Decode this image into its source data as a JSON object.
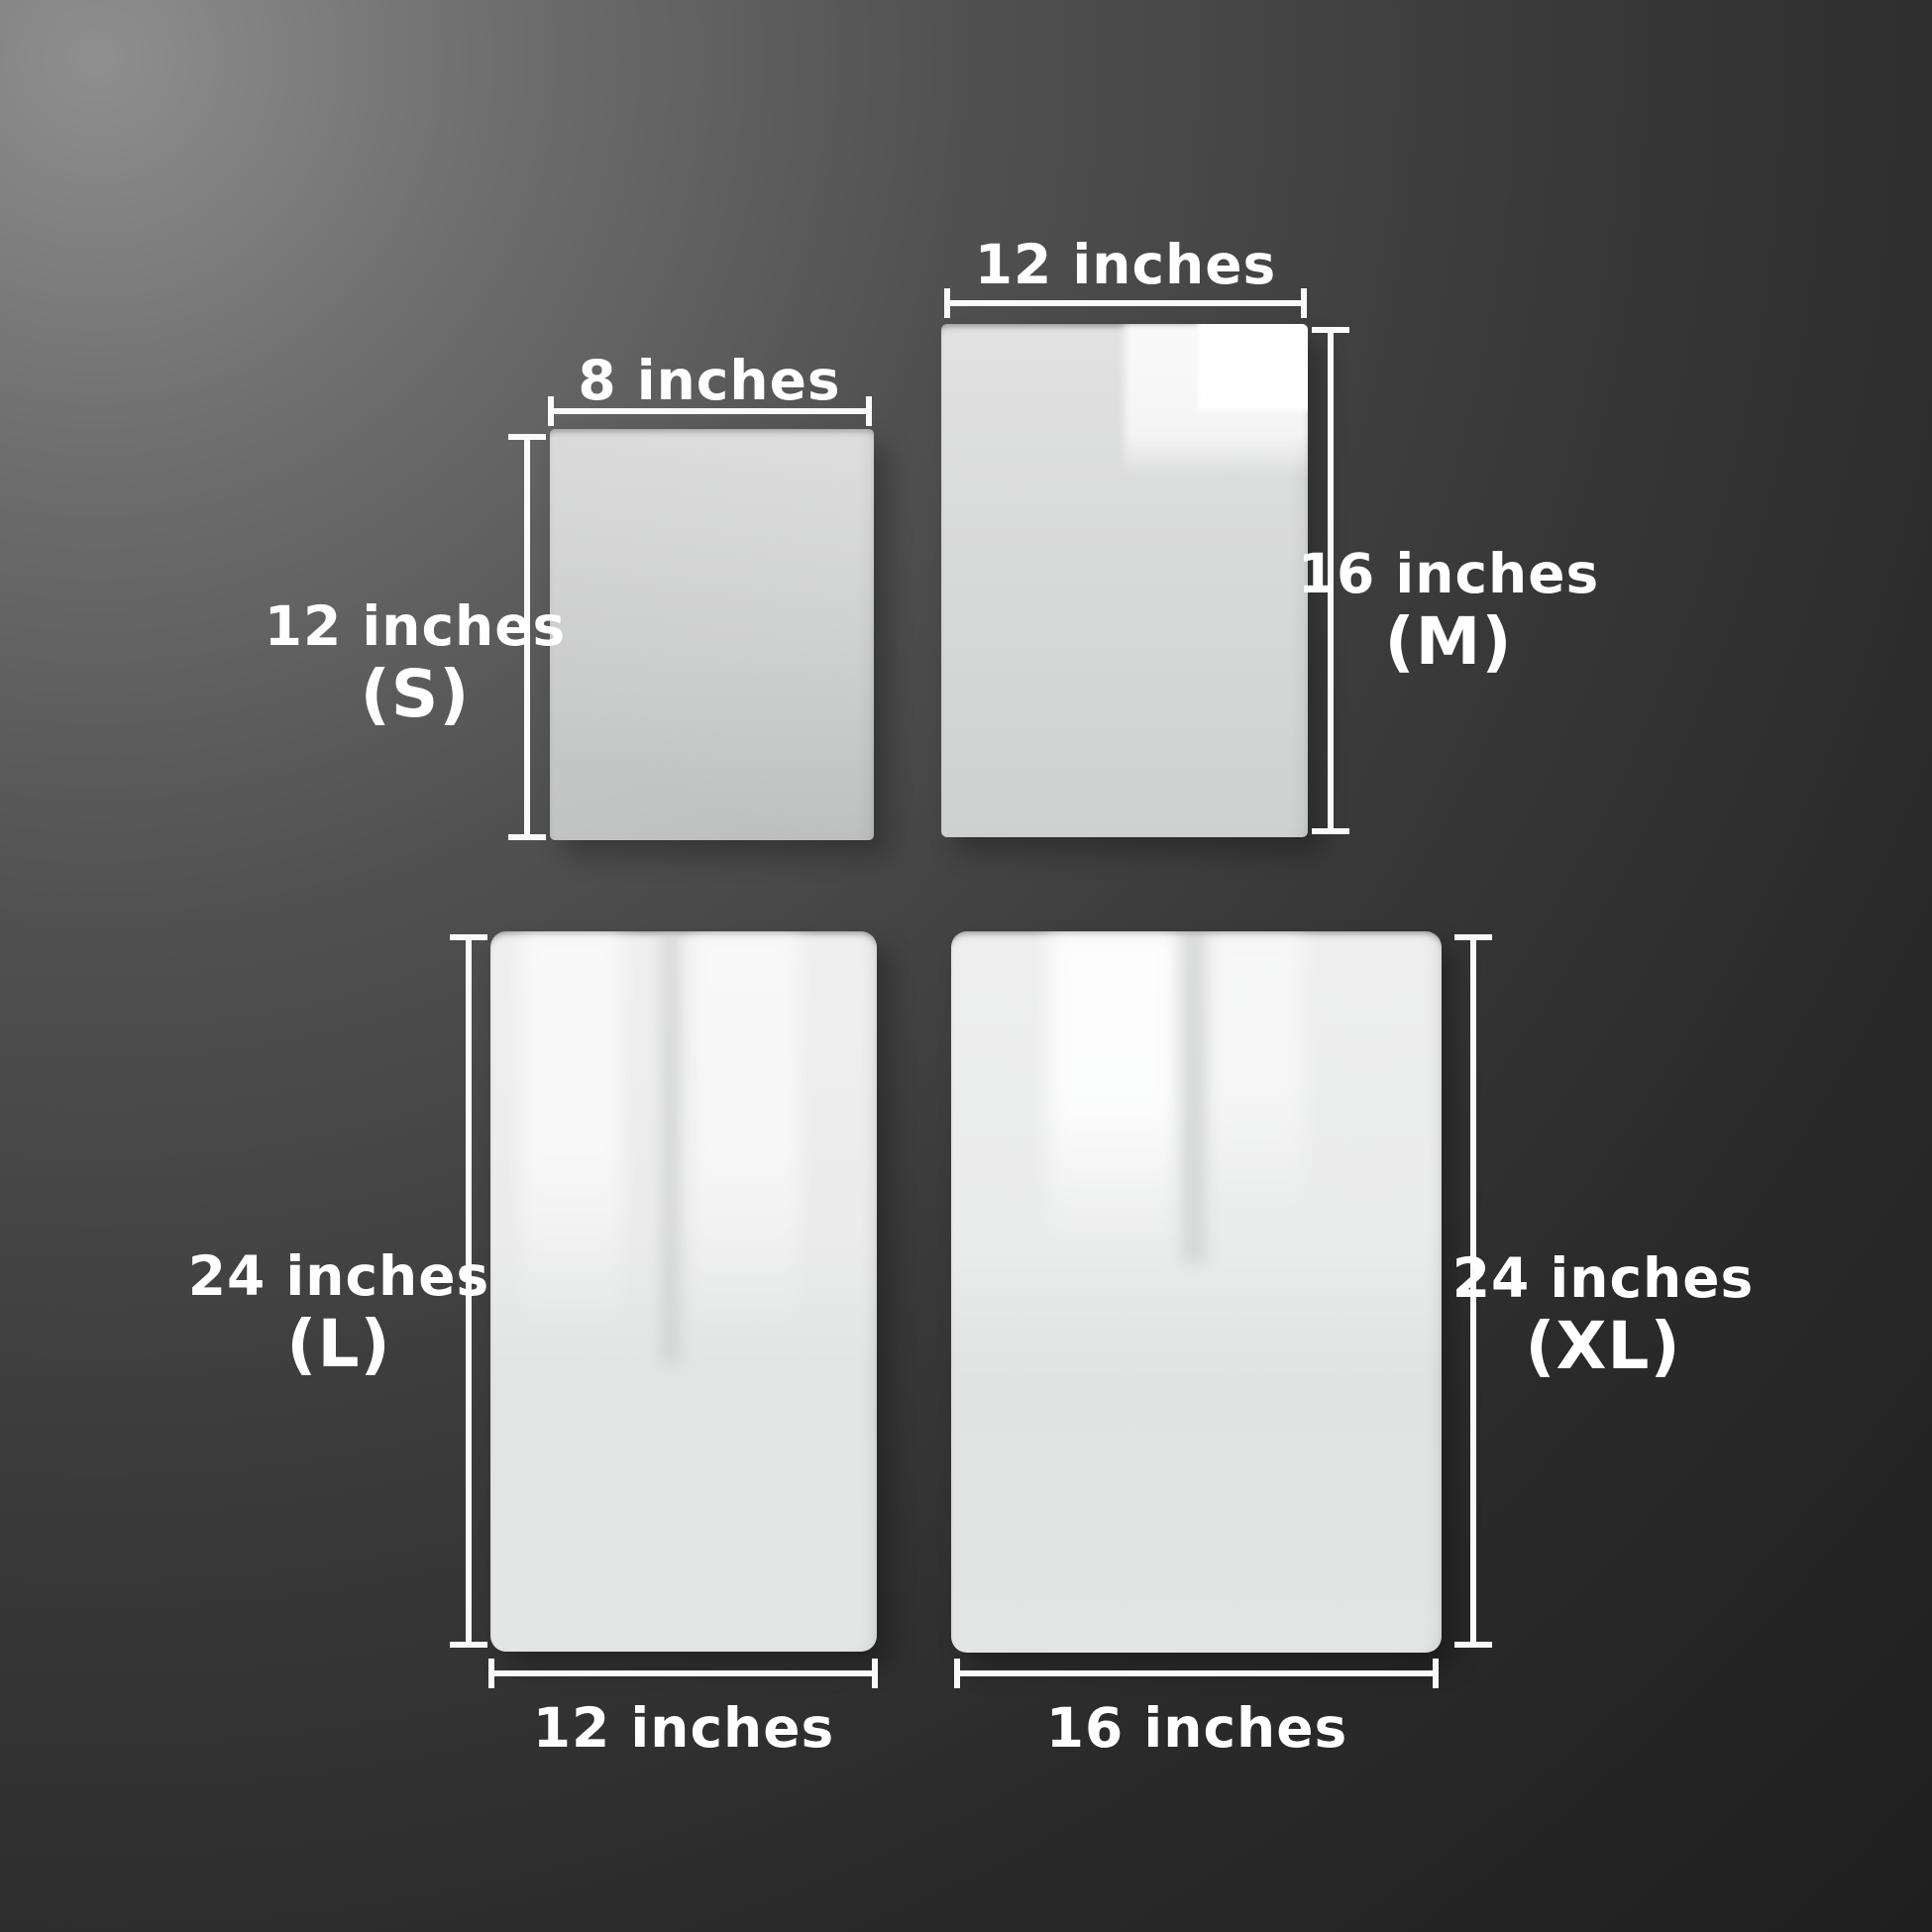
{
  "diagram": {
    "kind": "acrylic-sheet-size-comparison",
    "unit": "inches"
  },
  "colors": {
    "text": "#ffffff",
    "dimension_line": "#fafafa",
    "background_highlight": "#8f8f8f",
    "background_dark": "#1f1f1f",
    "sheet_base": "#d6d7d7",
    "sheet_reflection": "#f8f8f8"
  },
  "panels": [
    {
      "code": "S",
      "width_in": 8,
      "height_in": 12,
      "width_label": "8 inches",
      "height_label": "12 inches",
      "code_label": "(S)"
    },
    {
      "code": "M",
      "width_in": 12,
      "height_in": 16,
      "width_label": "12 inches",
      "height_label": "16 inches",
      "code_label": "(M)"
    },
    {
      "code": "L",
      "width_in": 12,
      "height_in": 24,
      "width_label": "12 inches",
      "height_label": "24 inches",
      "code_label": "(L)"
    },
    {
      "code": "XL",
      "width_in": 16,
      "height_in": 24,
      "width_label": "16 inches",
      "height_label": "24 inches",
      "code_label": "(XL)"
    }
  ]
}
